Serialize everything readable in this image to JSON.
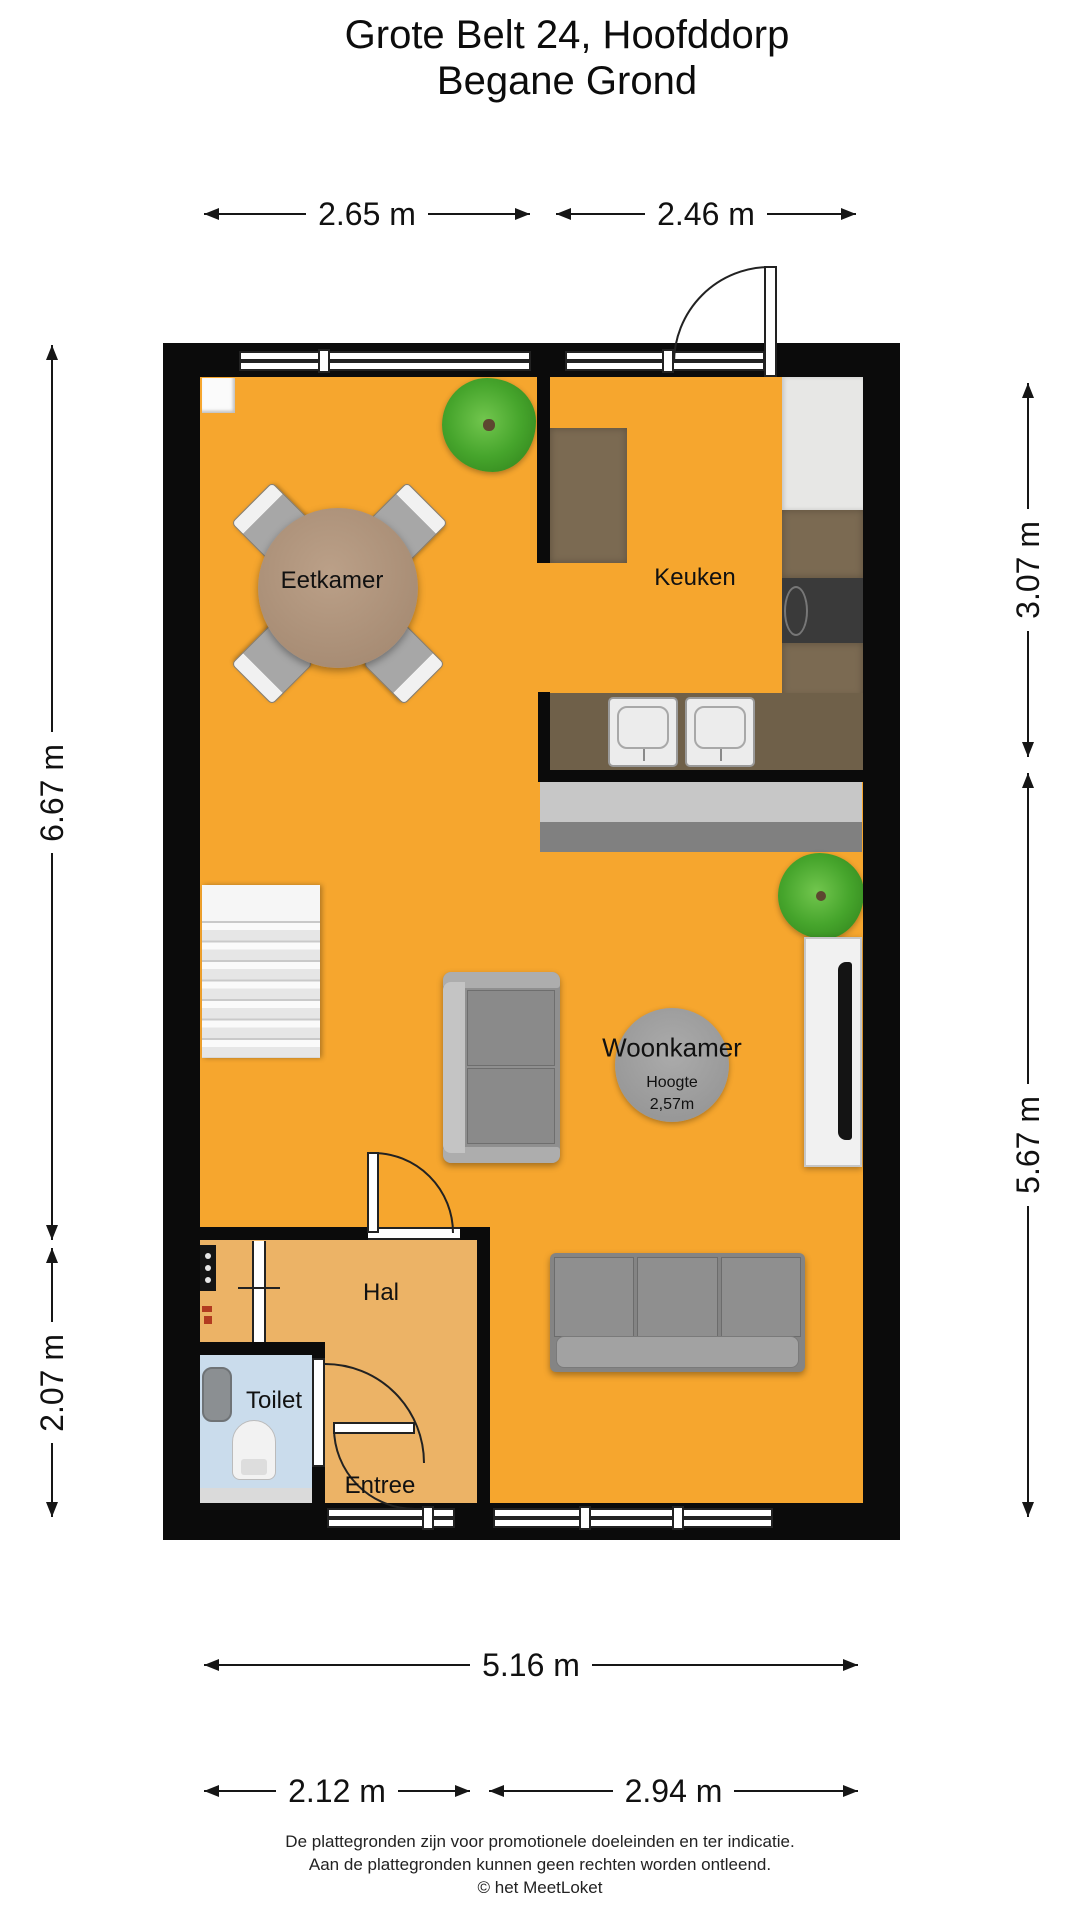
{
  "title": {
    "line1": "Grote Belt 24, Hoofddorp",
    "line2": "Begane Grond"
  },
  "rooms": {
    "eetkamer": "Eetkamer",
    "keuken": "Keuken",
    "woonkamer": "Woonkamer",
    "woonkamer_height_label": "Hoogte",
    "woonkamer_height_value": "2,57m",
    "hal": "Hal",
    "toilet": "Toilet",
    "entree": "Entree"
  },
  "dimensions": {
    "top_left": "2.65 m",
    "top_right": "2.46 m",
    "left_upper": "6.67 m",
    "left_lower": "2.07 m",
    "right_upper": "3.07 m",
    "right_lower": "5.67 m",
    "bottom_total": "5.16 m",
    "bottom_left": "2.12 m",
    "bottom_right": "2.94 m"
  },
  "footer": {
    "line1": "De plattegronden zijn voor promotionele doeleinden en ter indicatie.",
    "line2": "Aan de plattegronden kunnen geen rechten worden ontleend.",
    "line3": "© het MeetLoket"
  },
  "colors": {
    "floor_main": "#f6a62e",
    "floor_hall": "#ecb366",
    "floor_toilet": "#cadcec",
    "wall": "#0b0b0b",
    "counter": "#6f6049",
    "accent_plant": "#46a52c"
  }
}
